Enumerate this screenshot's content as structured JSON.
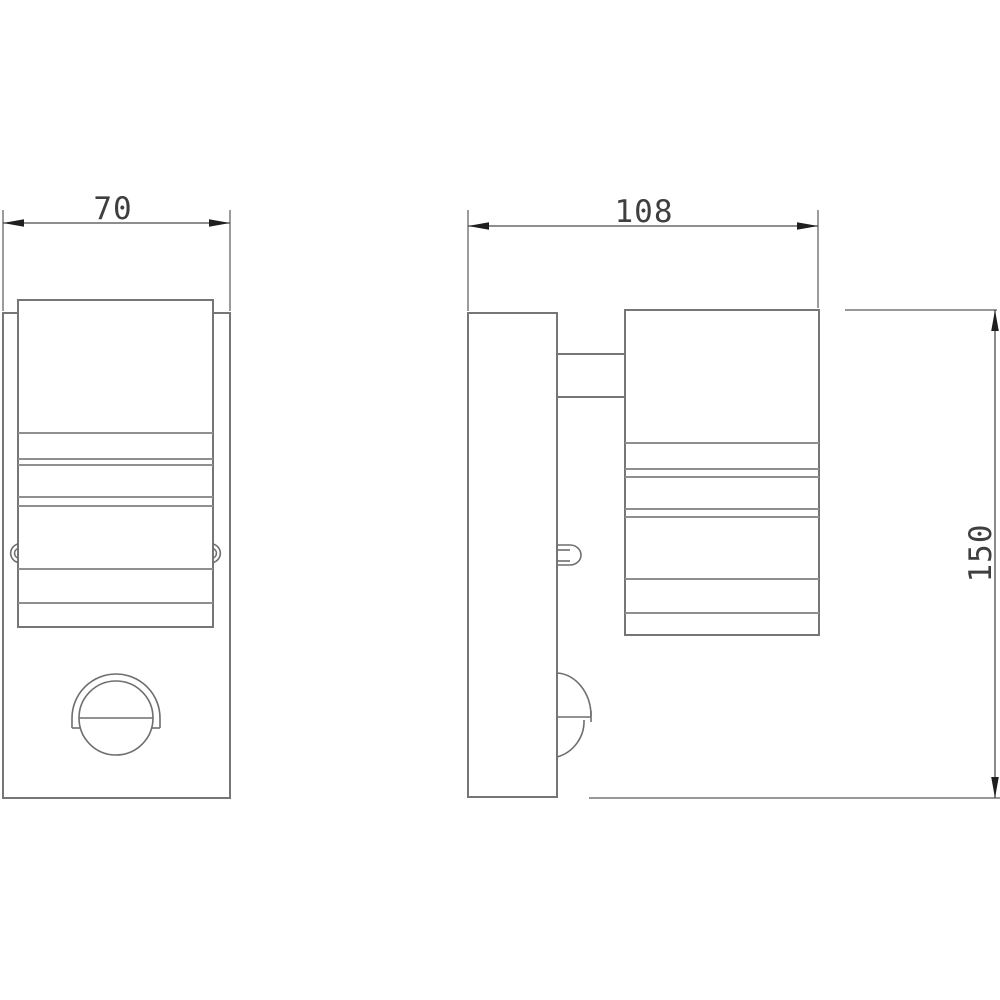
{
  "drawing": {
    "kind": "technical-dimension-drawing",
    "background_color": "#ffffff",
    "colors": {
      "object_outline": "#767676",
      "ridge_line": "#8f8f8f",
      "dimension_line": "#4a4a4a",
      "dimension_text": "#3f3f3f",
      "arrowhead": "#1f1f1f"
    },
    "front_view": {
      "width_dim": "70"
    },
    "side_view": {
      "depth_dim": "108",
      "height_dim": "150"
    }
  }
}
